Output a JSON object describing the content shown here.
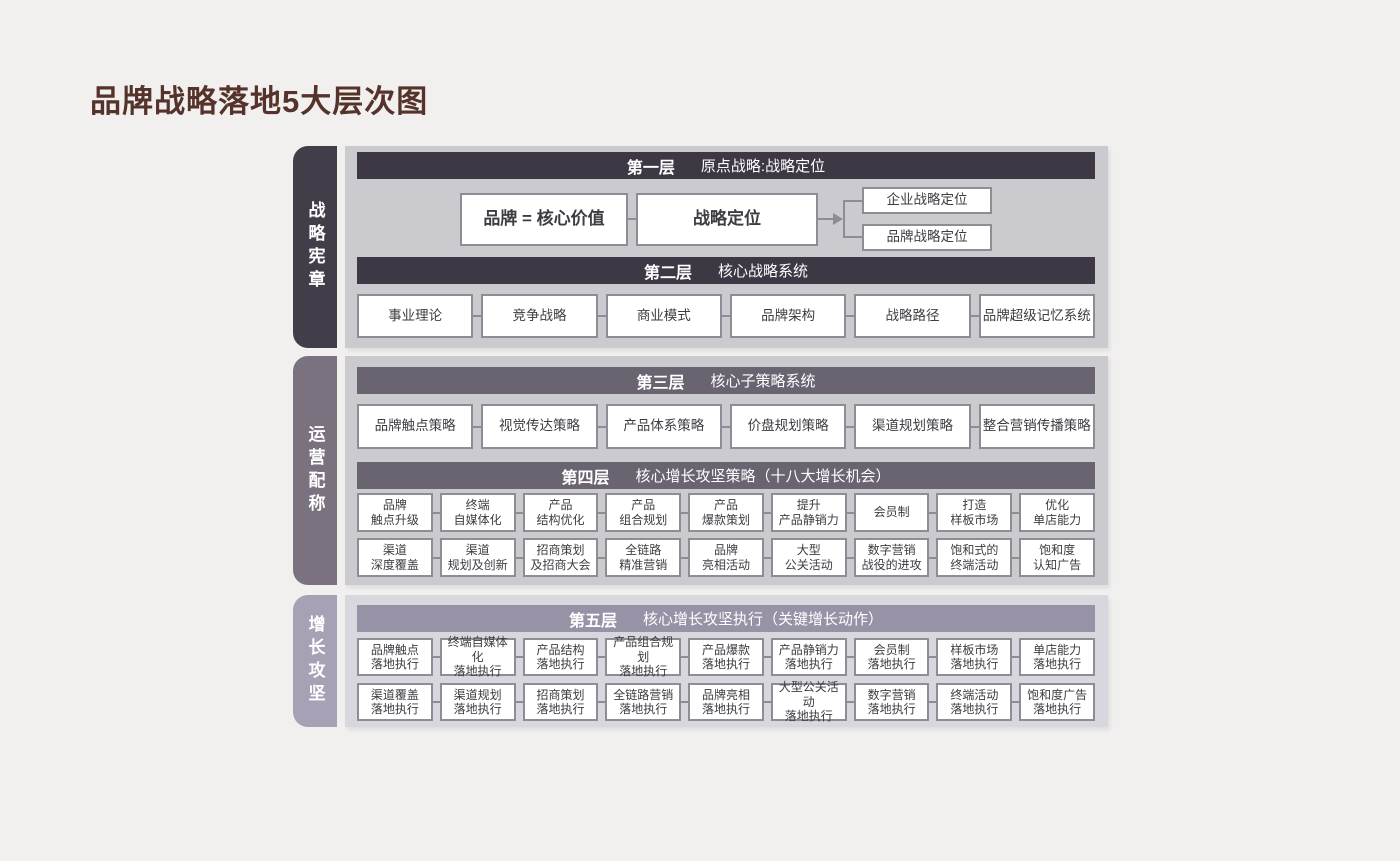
{
  "page": {
    "title": "品牌战略落地5大层次图"
  },
  "colors": {
    "page_bg": "#f1f0ee",
    "title_brown": "#55322a",
    "panel_gray": "#cbcacf",
    "panel_light_purple": "#d9d7de",
    "header_dark": "#3e3844",
    "header_mid": "#6a6370",
    "header_light": "#9892a7",
    "tab_dark": "#433d49",
    "tab_mid": "#7a727f",
    "tab_light": "#a8a1b6",
    "box_border": "#8d8d95"
  },
  "sections": [
    {
      "label": "战略宪章"
    },
    {
      "label": "运营配称"
    },
    {
      "label": "增长攻坚"
    }
  ],
  "layer1": {
    "tag": "第一层",
    "title": "原点战略:战略定位",
    "box_brand": "品牌 = 核心价值",
    "box_positioning": "战略定位",
    "targets": [
      "企业战略定位",
      "品牌战略定位"
    ]
  },
  "layer2": {
    "tag": "第二层",
    "title": "核心战略系统",
    "items": [
      "事业理论",
      "竞争战略",
      "商业模式",
      "品牌架构",
      "战略路径",
      "品牌超级记忆系统"
    ]
  },
  "layer3": {
    "tag": "第三层",
    "title": "核心子策略系统",
    "items": [
      "品牌触点策略",
      "视觉传达策略",
      "产品体系策略",
      "价盘规划策略",
      "渠道规划策略",
      "整合营销传播策略"
    ]
  },
  "layer4": {
    "tag": "第四层",
    "title": "核心增长攻坚策略（十八大增长机会）",
    "row1": [
      "品牌\n触点升级",
      "终端\n自媒体化",
      "产品\n结构优化",
      "产品\n组合规划",
      "产品\n爆款策划",
      "提升\n产品静销力",
      "会员制",
      "打造\n样板市场",
      "优化\n单店能力"
    ],
    "row2": [
      "渠道\n深度覆盖",
      "渠道\n规划及创新",
      "招商策划\n及招商大会",
      "全链路\n精准营销",
      "品牌\n亮相活动",
      "大型\n公关活动",
      "数字营销\n战役的进攻",
      "饱和式的\n终端活动",
      "饱和度\n认知广告"
    ]
  },
  "layer5": {
    "tag": "第五层",
    "title": "核心增长攻坚执行（关键增长动作）",
    "row1": [
      "品牌触点\n落地执行",
      "终端自媒体化\n落地执行",
      "产品结构\n落地执行",
      "产品组合规划\n落地执行",
      "产品爆款\n落地执行",
      "产品静销力\n落地执行",
      "会员制\n落地执行",
      "样板市场\n落地执行",
      "单店能力\n落地执行"
    ],
    "row2": [
      "渠道覆盖\n落地执行",
      "渠道规划\n落地执行",
      "招商策划\n落地执行",
      "全链路营销\n落地执行",
      "品牌亮相\n落地执行",
      "大型公关活动\n落地执行",
      "数字营销\n落地执行",
      "终端活动\n落地执行",
      "饱和度广告\n落地执行"
    ]
  }
}
